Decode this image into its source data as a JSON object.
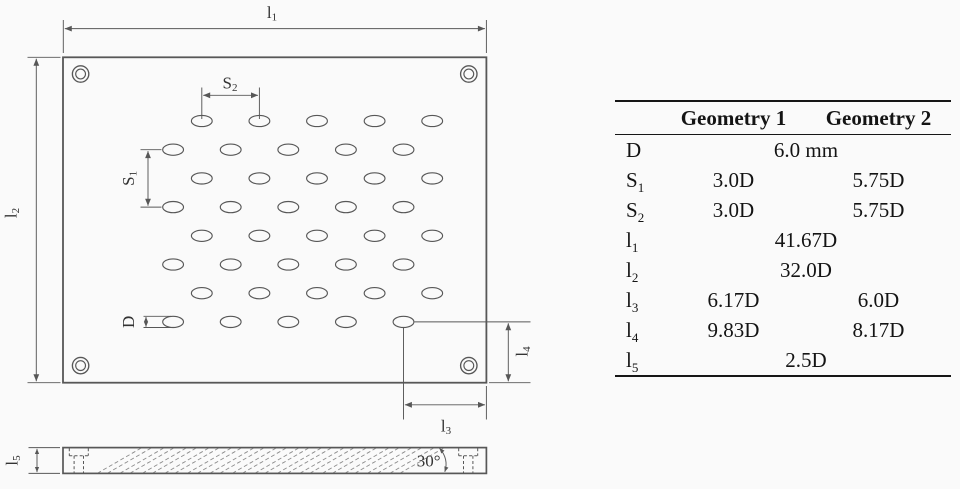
{
  "figure": {
    "colors": {
      "background": "#fafafa",
      "line": "#575757",
      "drawing_text": "#333333",
      "table_text": "#141414",
      "table_rule": "#161616",
      "hatch": "#8c8c8c"
    }
  },
  "drawing": {
    "labels": {
      "l1": {
        "base": "l",
        "sub": "1"
      },
      "l2": {
        "base": "l",
        "sub": "2"
      },
      "l3": {
        "base": "l",
        "sub": "3"
      },
      "l4": {
        "base": "l",
        "sub": "4"
      },
      "l5": {
        "base": "l",
        "sub": "5"
      },
      "s1": {
        "base": "S",
        "sub": "1"
      },
      "s2": {
        "base": "S",
        "sub": "2"
      },
      "d": {
        "base": "D",
        "sub": ""
      },
      "angle": "30°"
    },
    "hole_pattern": {
      "rows": 8,
      "cols": 5,
      "y0": 121,
      "row_pitch": 28.7,
      "x0_first": 201.8,
      "x0_offset_rows": 173.1,
      "col_pitch": 57.6,
      "rx": 10.4,
      "ry": 5.6
    },
    "hatch": {
      "x_start": 97.5,
      "x_end": 400,
      "pair_pitch": 22.5,
      "pair_gap": 10,
      "y_bottom": 473.2,
      "y_top": 447.3,
      "rise_dx": 45
    }
  },
  "table": {
    "col_headers": [
      "Geometry 1",
      "Geometry 2"
    ],
    "rows": [
      {
        "id": "D",
        "label": {
          "base": "D",
          "sub": ""
        },
        "type": "span",
        "value": "6.0 mm"
      },
      {
        "id": "S1",
        "label": {
          "base": "S",
          "sub": "1"
        },
        "type": "pair",
        "g1": "3.0D",
        "g2": "5.75D"
      },
      {
        "id": "S2",
        "label": {
          "base": "S",
          "sub": "2"
        },
        "type": "pair",
        "g1": "3.0D",
        "g2": "5.75D"
      },
      {
        "id": "l1",
        "label": {
          "base": "l",
          "sub": "1"
        },
        "type": "span",
        "value": "41.67D"
      },
      {
        "id": "l2",
        "label": {
          "base": "l",
          "sub": "2"
        },
        "type": "span",
        "value": "32.0D"
      },
      {
        "id": "l3",
        "label": {
          "base": "l",
          "sub": "3"
        },
        "type": "pair",
        "g1": "6.17D",
        "g2": "6.0D"
      },
      {
        "id": "l4",
        "label": {
          "base": "l",
          "sub": "4"
        },
        "type": "pair",
        "g1": "9.83D",
        "g2": "8.17D"
      },
      {
        "id": "l5",
        "label": {
          "base": "l",
          "sub": "5"
        },
        "type": "span",
        "value": "2.5D"
      }
    ]
  }
}
